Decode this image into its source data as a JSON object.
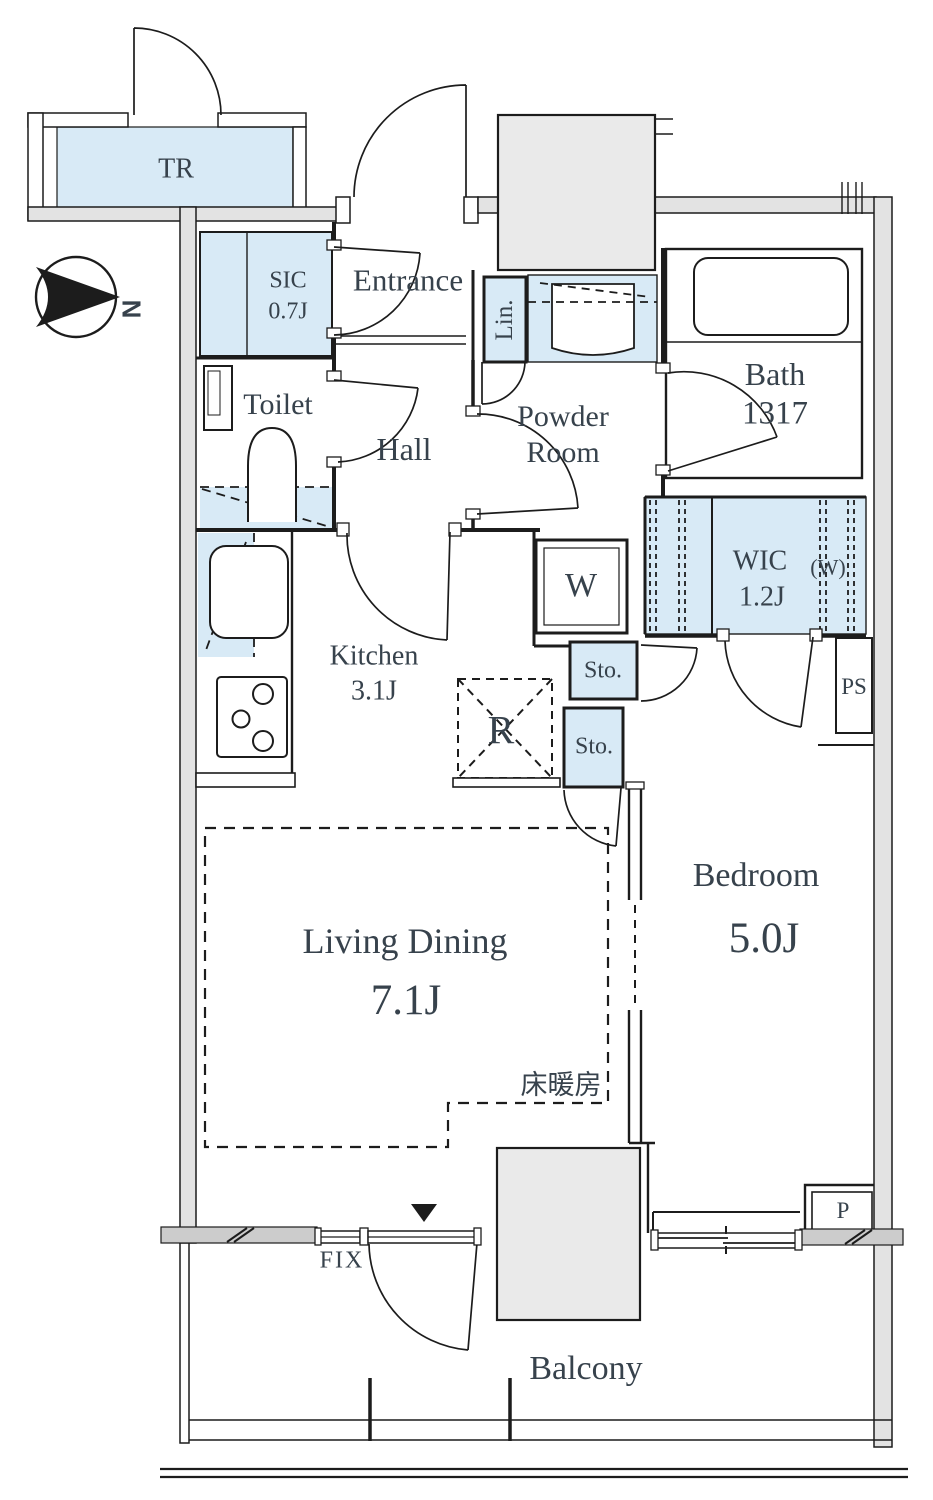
{
  "plan": {
    "rooms": {
      "tr": {
        "label": "TR"
      },
      "sic": {
        "label": "SIC",
        "area": "0.7J"
      },
      "entrance": {
        "label": "Entrance"
      },
      "toilet": {
        "label": "Toilet"
      },
      "hall": {
        "label": "Hall"
      },
      "powder_room": {
        "label_top": "Powder",
        "label_bottom": "Room"
      },
      "bath": {
        "label": "Bath",
        "size": "1317"
      },
      "linen": {
        "label": "Lin."
      },
      "washer": {
        "label": "W"
      },
      "wic": {
        "label": "WIC",
        "area": "1.2J",
        "note": "(W)"
      },
      "sto_upper": {
        "label": "Sto."
      },
      "sto_lower": {
        "label": "Sto."
      },
      "ps": {
        "label": "PS"
      },
      "kitchen": {
        "label": "Kitchen",
        "area": "3.1J"
      },
      "fridge": {
        "label": "R"
      },
      "living_dining": {
        "label": "Living Dining",
        "area": "7.1J"
      },
      "floor_heating": {
        "label": "床暖房"
      },
      "bedroom": {
        "label": "Bedroom",
        "area": "5.0J"
      },
      "pipe": {
        "label": "P"
      },
      "fix_window": {
        "label": "FIX"
      },
      "balcony": {
        "label": "Balcony"
      }
    },
    "compass": {
      "label": "N"
    },
    "colors": {
      "closet_fill": "#d8eaf6",
      "block_fill": "#eaeaea",
      "wall_fill": "#e3e3e3",
      "hatch_bar_fill": "#cccccc",
      "line": "#1c1c1c",
      "text": "#37424c"
    }
  }
}
